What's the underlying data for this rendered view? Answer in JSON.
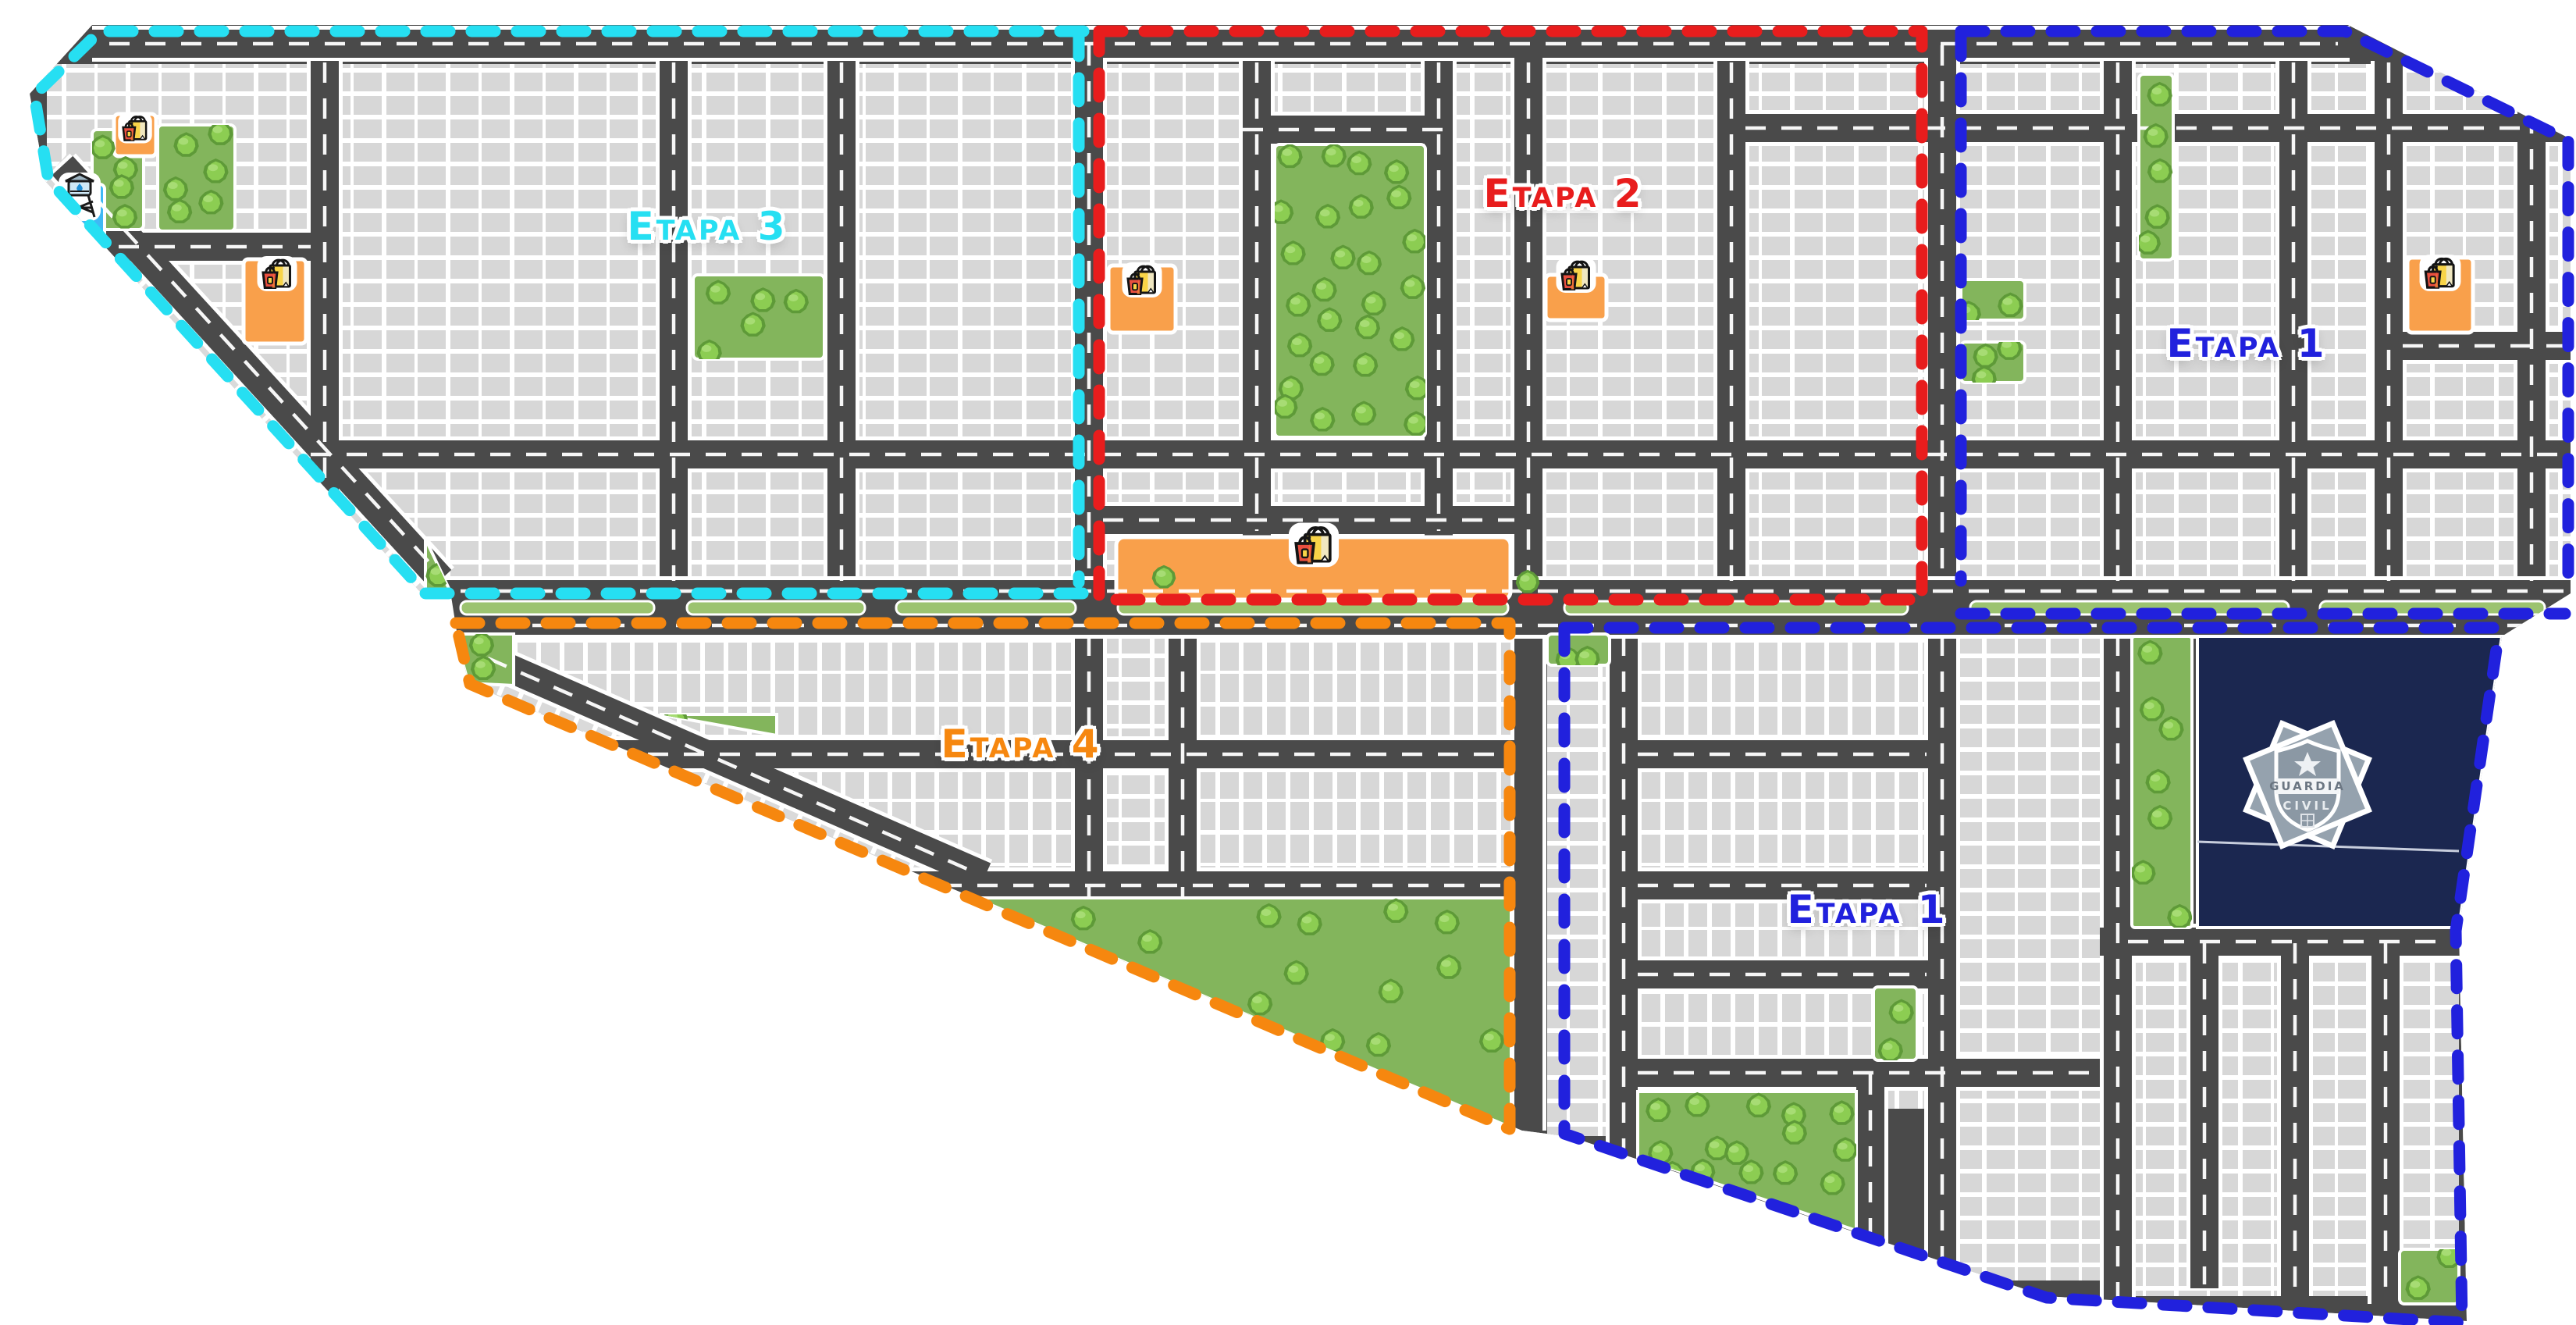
{
  "map": {
    "stages": [
      {
        "id": "etapa-3",
        "label": "Etapa 3",
        "color": "#26dff2"
      },
      {
        "id": "etapa-2",
        "label": "Etapa 2",
        "color": "#e81d1d"
      },
      {
        "id": "etapa-1-norte",
        "label": "Etapa 1",
        "color": "#2121dd"
      },
      {
        "id": "etapa-4",
        "label": "Etapa 4",
        "color": "#f6870f"
      },
      {
        "id": "etapa-1-sur",
        "label": "Etapa 1",
        "color": "#2121dd"
      }
    ],
    "landmarks": {
      "police_badge": {
        "line1": "GUARDIA",
        "line2": "CIVIL"
      }
    },
    "icons": [
      {
        "name": "shopping-bags-icon"
      },
      {
        "name": "water-tower-icon"
      },
      {
        "name": "police-badge-icon"
      },
      {
        "name": "tree-icon"
      }
    ],
    "colors": {
      "etapa_1": "#2121dd",
      "etapa_2": "#e81d1d",
      "etapa_3": "#26dff2",
      "etapa_4": "#f6870f",
      "road": "#4a4a4a",
      "residential_lot": "#d7d7d7",
      "park_green": "#83b55c",
      "tree_green": "#8ccd52",
      "median_green": "#9cc370",
      "commercial_orange": "#f9a04b",
      "police_navy": "#1b2750",
      "water_blue": "#3fb9f5"
    }
  }
}
